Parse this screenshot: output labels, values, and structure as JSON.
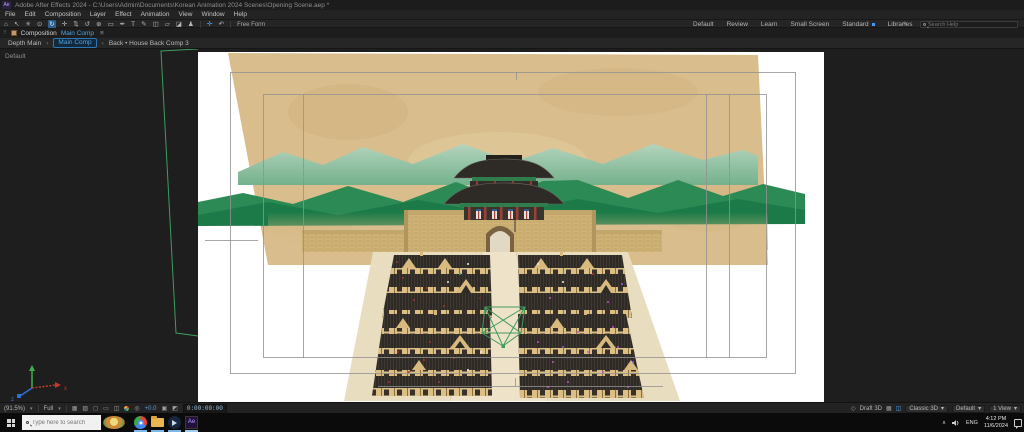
{
  "titlebar": {
    "app_badge": "Ae",
    "title": "Adobe After Effects 2024 - C:\\Users\\Admin\\Documents\\Korean Animation 2024 Scenes\\Opening Scene.aep *"
  },
  "menubar": {
    "items": [
      "File",
      "Edit",
      "Composition",
      "Layer",
      "Effect",
      "Animation",
      "View",
      "Window",
      "Help"
    ]
  },
  "toolbar": {
    "tools": [
      {
        "name": "home-tool",
        "glyph": "⌂"
      },
      {
        "name": "selection-tool",
        "glyph": "↖"
      },
      {
        "name": "hand-tool",
        "glyph": "✳"
      },
      {
        "name": "zoom-tool",
        "glyph": "⊙"
      },
      {
        "name": "orbit-camera-tool",
        "glyph": "↻"
      },
      {
        "name": "pan-camera-tool",
        "glyph": "✛"
      },
      {
        "name": "dolly-camera-tool",
        "glyph": "⇅"
      },
      {
        "name": "rotation-tool",
        "glyph": "↺"
      },
      {
        "name": "pan-behind-tool",
        "glyph": "⊕"
      },
      {
        "name": "rectangle-tool",
        "glyph": "▭"
      },
      {
        "name": "pen-tool",
        "glyph": "✒"
      },
      {
        "name": "type-tool",
        "glyph": "T"
      },
      {
        "name": "brush-tool",
        "glyph": "✎"
      },
      {
        "name": "clone-stamp-tool",
        "glyph": "◫"
      },
      {
        "name": "eraser-tool",
        "glyph": "▱"
      },
      {
        "name": "roto-brush-tool",
        "glyph": "◪"
      },
      {
        "name": "puppet-pin-tool",
        "glyph": "♟"
      }
    ],
    "gizmo_universal_glyph": "✛",
    "gizmo_reset_glyph": "↶",
    "free_form_label": "Free Form",
    "workspaces": [
      "Default",
      "Review",
      "Learn",
      "Small Screen",
      "Standard",
      "Libraries"
    ],
    "active_workspace": "Standard",
    "overflow_glyph": "»",
    "search_placeholder": "Search Help"
  },
  "comp_panel": {
    "grip_glyph": "⠿",
    "tab_label": "Composition",
    "comp_name": "Main Comp",
    "menu_glyph": "≡",
    "breadcrumb": {
      "item_0": "Depth Main",
      "item_1": "Main Comp",
      "item_2": "Back • House Back Comp 3",
      "sep": "‹"
    },
    "view_label": "Default"
  },
  "viewer_footer": {
    "magnification": "(91.5%)",
    "arrow": "▾",
    "resolution": "Full",
    "icons": {
      "grid": "▦",
      "transparency": "▨",
      "mask": "◻",
      "roi": "▭",
      "view_options": "◫",
      "aperture": "◎",
      "snapshot": "▣",
      "show_snapshot": "◩",
      "cube": "◇",
      "ground_plane": "▦",
      "extended_viewer": "◫"
    },
    "exposure": "+0.0",
    "timecode": "0:00:00:00",
    "draft_3d": "Draft 3D",
    "renderer": "Classic 3D",
    "view_layout": "Default",
    "view_count": "1 View"
  },
  "taskbar": {
    "search_placeholder": "Type here to search",
    "tray": {
      "chevron": "∧",
      "language": "ENG",
      "time": "4:12 PM",
      "date": "11/6/2024"
    }
  }
}
